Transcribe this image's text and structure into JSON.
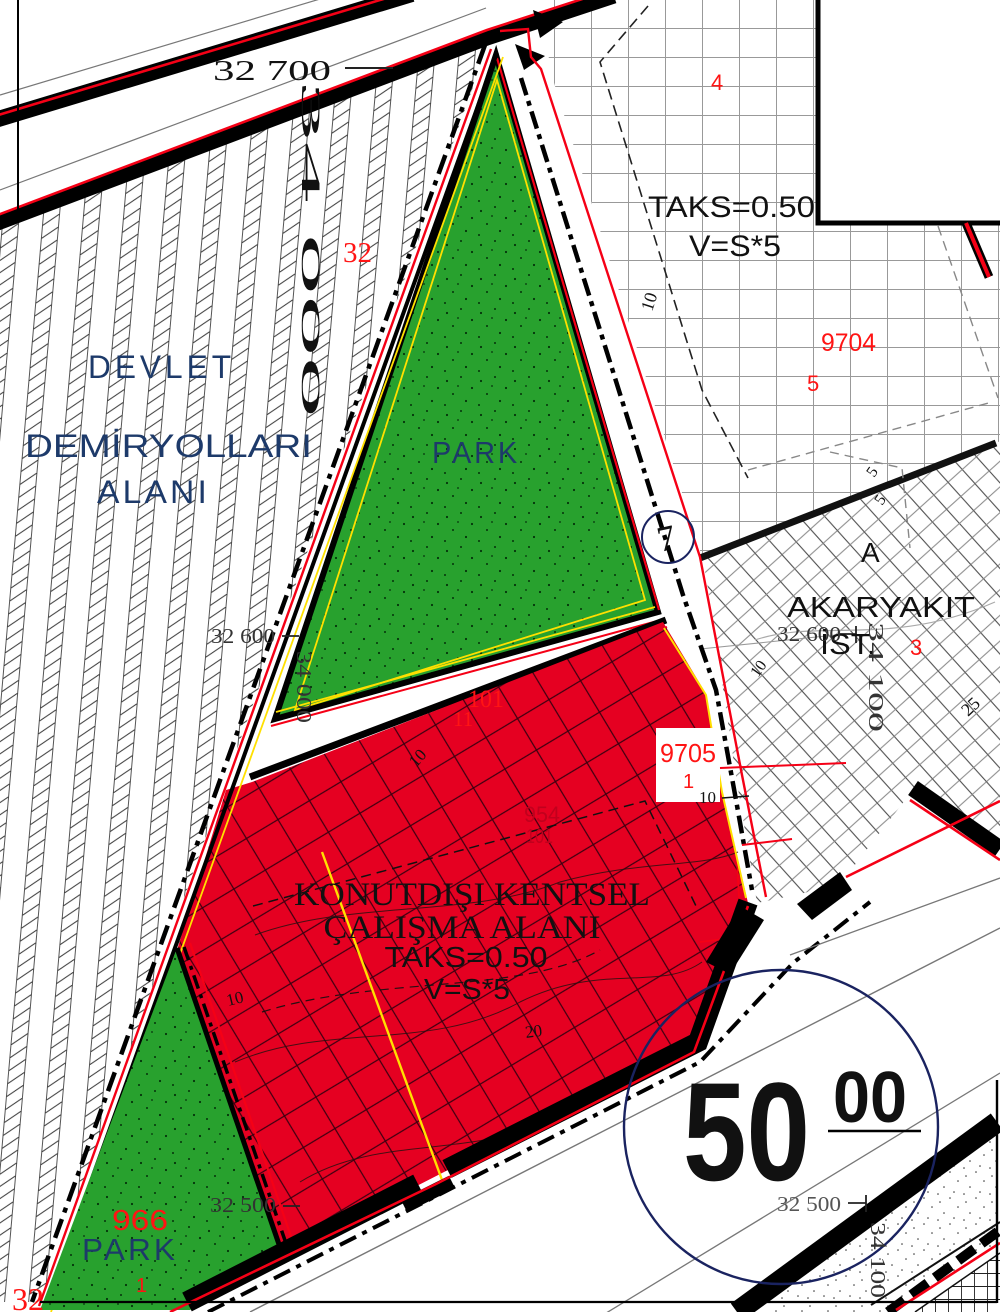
{
  "colors": {
    "zone_green": "#28A12E",
    "zone_red": "#E50021",
    "navy": "#1d3a6a",
    "label_red": "#ff1414",
    "dark_red": "#c1001d",
    "yellow": "#ffe000",
    "road_black": "#000000",
    "grid_gray": "#999999"
  },
  "zones": {
    "railway_area": {
      "name": "DEVLET DEMİRYOLLARI ALANI"
    },
    "park_north": {
      "name": "PARK",
      "block": "32"
    },
    "park_south": {
      "name": "PARK",
      "parcel": "966",
      "lot": "1",
      "block": "32"
    },
    "commercial_area": {
      "name": "KONUTDIŞI KENTSEL ÇALIŞMA ALANI",
      "taks": "TAKS=0.50",
      "v": "V=S*5",
      "parcels": [
        "101",
        "11",
        "9705",
        "1",
        "954",
        "101"
      ]
    },
    "fuel_station": {
      "block": "A",
      "name": "AKARYAKIT İST.",
      "parcel": "3"
    },
    "grid_block": {
      "taks": "TAKS=0.50",
      "v": "V=S*5",
      "parcels": [
        "4",
        "9704",
        "5"
      ]
    },
    "road_node": "7",
    "elevation_mark": "50 00",
    "coordinates": [
      "32 700",
      "32 600",
      "32 500",
      "34 000",
      "34 100"
    ],
    "dimensions": [
      "10",
      "20",
      "25",
      "5"
    ]
  },
  "labels": [
    {
      "id": "coord-32700",
      "text": "32 700",
      "x": 213,
      "y": 80,
      "fs": 29,
      "font": "serif",
      "len": 118
    },
    {
      "id": "coord-34000-top",
      "text": "34 000",
      "x": 302,
      "y": 80,
      "fs": 26,
      "font": "serif",
      "rot": 90,
      "len": 338
    },
    {
      "id": "parcel-32-top",
      "text": "32",
      "x": 343,
      "y": 262,
      "fs": 29,
      "font": "serif",
      "color": "red"
    },
    {
      "id": "zone-devlet",
      "text": "DEVLET",
      "x": 88,
      "y": 378,
      "fs": 32,
      "color": "navy",
      "len": 147,
      "ls": 4
    },
    {
      "id": "zone-demiryollari",
      "text": "DEMİRYOLLARI",
      "x": 25,
      "y": 457,
      "fs": 32,
      "color": "navy",
      "len": 287
    },
    {
      "id": "zone-alani",
      "text": "ALANI",
      "x": 97,
      "y": 503,
      "fs": 32,
      "color": "navy",
      "len": 113,
      "ls": 3
    },
    {
      "id": "zone-park-north",
      "text": "PARK",
      "x": 432,
      "y": 463,
      "fs": 31,
      "color": "navy",
      "len": 88,
      "ls": 3
    },
    {
      "id": "rule-taks-north",
      "text": "TAKS=0.50",
      "x": 648,
      "y": 217,
      "fs": 30,
      "len": 167
    },
    {
      "id": "rule-v-north",
      "text": "V=S*5",
      "x": 689,
      "y": 256,
      "fs": 30,
      "len": 92
    },
    {
      "id": "parcel-4",
      "text": "4",
      "x": 711,
      "y": 90,
      "fs": 22,
      "color": "red"
    },
    {
      "id": "parcel-9704",
      "text": "9704",
      "x": 821,
      "y": 351,
      "fs": 25,
      "color": "red",
      "len": 55
    },
    {
      "id": "parcel-5",
      "text": "5",
      "x": 807,
      "y": 391,
      "fs": 22,
      "color": "red"
    },
    {
      "id": "dim-10-north",
      "text": "10",
      "x": 652,
      "y": 312,
      "fs": 18,
      "font": "serif",
      "rot": -72
    },
    {
      "id": "block-a",
      "text": "A",
      "x": 861,
      "y": 562,
      "fs": 28
    },
    {
      "id": "zone-akaryakit",
      "text": "AKARYAKIT",
      "x": 787,
      "y": 617,
      "fs": 29,
      "len": 188
    },
    {
      "id": "zone-ist",
      "text": "İST.",
      "x": 820,
      "y": 654,
      "fs": 29,
      "len": 56
    },
    {
      "id": "parcel-3",
      "text": "3",
      "x": 910,
      "y": 655,
      "fs": 22,
      "color": "red"
    },
    {
      "id": "coord-32600-right",
      "text": "32 600",
      "x": 777,
      "y": 641,
      "fs": 21,
      "font": "serif",
      "color": "#333333",
      "len": 64
    },
    {
      "id": "coord-34100-right",
      "text": "34 100",
      "x": 869,
      "y": 622,
      "fs": 21,
      "font": "serif",
      "color": "#333333",
      "rot": 90,
      "len": 110
    },
    {
      "id": "dim-5a",
      "text": "5",
      "x": 874,
      "y": 478,
      "fs": 16,
      "font": "serif",
      "rot": -55
    },
    {
      "id": "dim-5b",
      "text": "5",
      "x": 882,
      "y": 506,
      "fs": 16,
      "font": "serif",
      "rot": -55
    },
    {
      "id": "dim-10-ak",
      "text": "10",
      "x": 758,
      "y": 678,
      "fs": 16,
      "font": "serif",
      "rot": -55
    },
    {
      "id": "dim-25",
      "text": "25",
      "x": 968,
      "y": 717,
      "fs": 18,
      "font": "serif",
      "rot": -43
    },
    {
      "id": "coord-32600-left",
      "text": "32 600",
      "x": 211,
      "y": 643,
      "fs": 21,
      "font": "serif",
      "color": "#333333",
      "len": 64
    },
    {
      "id": "coord-34000-mid",
      "text": "34 000",
      "x": 297,
      "y": 651,
      "fs": 21,
      "font": "serif",
      "color": "#333333",
      "rot": 90,
      "len": 72
    },
    {
      "id": "parcel-101",
      "text": "101",
      "x": 468,
      "y": 707,
      "fs": 25,
      "font": "serif",
      "color": "red",
      "len": 36
    },
    {
      "id": "parcel-11",
      "text": "11",
      "x": 453,
      "y": 726,
      "fs": 21,
      "font": "serif",
      "color": "red"
    },
    {
      "id": "parcel-9705",
      "text": "9705",
      "x": 660,
      "y": 762,
      "fs": 26,
      "color": "red",
      "len": 56
    },
    {
      "id": "parcel-1-mid",
      "text": "1",
      "x": 683,
      "y": 788,
      "fs": 20,
      "color": "red"
    },
    {
      "id": "dim-10-9705",
      "text": "10",
      "x": 699,
      "y": 803,
      "fs": 17,
      "font": "serif"
    },
    {
      "id": "parcel-954",
      "text": "954",
      "x": 524,
      "y": 822,
      "fs": 22,
      "color": "darkred",
      "len": 36
    },
    {
      "id": "parcel-101b",
      "text": "101",
      "x": 526,
      "y": 843,
      "fs": 20,
      "color": "darkred",
      "len": 27
    },
    {
      "id": "dim-10-red",
      "text": "10",
      "x": 416,
      "y": 768,
      "fs": 17,
      "font": "serif",
      "rot": -48
    },
    {
      "id": "zone-konut-1",
      "text": "KONUTDIŞI KENTSEL",
      "x": 472,
      "y": 905,
      "fs": 33,
      "font": "serif",
      "anchor": "middle",
      "len": 356
    },
    {
      "id": "zone-konut-2",
      "text": "ÇALIŞMA ALANI",
      "x": 462,
      "y": 938,
      "fs": 33,
      "font": "serif",
      "anchor": "middle",
      "len": 277
    },
    {
      "id": "rule-taks-red",
      "text": "TAKS=0.50",
      "x": 466,
      "y": 967,
      "fs": 29,
      "anchor": "middle",
      "len": 163
    },
    {
      "id": "rule-v-red",
      "text": "V=S*5",
      "x": 467,
      "y": 999,
      "fs": 29,
      "anchor": "middle",
      "len": 86
    },
    {
      "id": "dim-20",
      "text": "20",
      "x": 526,
      "y": 1038,
      "fs": 17,
      "font": "serif",
      "rot": -8
    },
    {
      "id": "dim-10-bl",
      "text": "10",
      "x": 228,
      "y": 1006,
      "fs": 17,
      "font": "serif",
      "rot": -14
    },
    {
      "id": "parcel-966",
      "text": "966",
      "x": 112,
      "y": 1230,
      "fs": 29,
      "color": "red",
      "len": 56
    },
    {
      "id": "zone-park-south",
      "text": "PARK",
      "x": 82,
      "y": 1260,
      "fs": 31,
      "color": "navy",
      "len": 96,
      "ls": 3
    },
    {
      "id": "parcel-1-south",
      "text": "1",
      "x": 136,
      "y": 1292,
      "fs": 20,
      "color": "red"
    },
    {
      "id": "coord-32500-left",
      "text": "32 500",
      "x": 210,
      "y": 1212,
      "fs": 21,
      "font": "serif",
      "color": "#333333",
      "len": 66
    },
    {
      "id": "parcel-32-bl",
      "text": "32",
      "x": 12,
      "y": 1310,
      "fs": 32,
      "font": "serif",
      "color": "red"
    },
    {
      "id": "coord-32500-right",
      "text": "32 500",
      "x": 777,
      "y": 1211,
      "fs": 21,
      "font": "serif",
      "color": "#555555",
      "len": 64
    },
    {
      "id": "coord-34100-bottom",
      "text": "34 100",
      "x": 871,
      "y": 1222,
      "fs": 21,
      "font": "serif",
      "color": "#333333",
      "rot": 90,
      "len": 76
    },
    {
      "id": "elev-50",
      "text": "50",
      "x": 683,
      "y": 1180,
      "fs": 140,
      "w": 700,
      "len": 127
    },
    {
      "id": "elev-00",
      "text": "00",
      "x": 833,
      "y": 1122,
      "fs": 72,
      "w": 700,
      "len": 74
    },
    {
      "id": "node-7",
      "text": "7",
      "x": 660,
      "y": 552,
      "fs": 36,
      "font": "serif",
      "rot": -12
    }
  ]
}
